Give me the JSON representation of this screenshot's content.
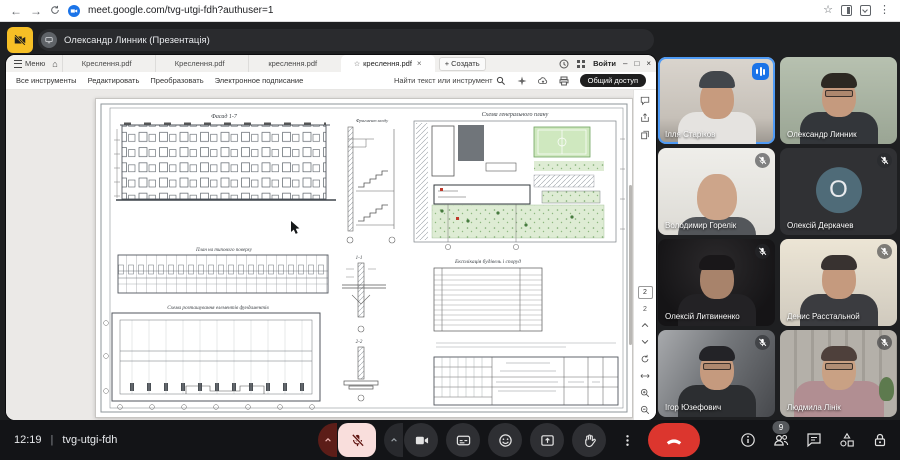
{
  "browser": {
    "url": "meet.google.com/tvg-utgi-fdh?authuser=1"
  },
  "banner": {
    "label": "Олександр Линник (Презентація)"
  },
  "acrobat": {
    "menu": "Меню",
    "tabs": [
      {
        "label": "Креслення.pdf",
        "active": false
      },
      {
        "label": "Креслення.pdf",
        "active": false
      },
      {
        "label": "креслення.pdf",
        "active": false
      },
      {
        "label": "креслення.pdf",
        "active": true
      }
    ],
    "create": "Создать",
    "signin": "Войти",
    "menus": [
      "Все инструменты",
      "Редактировать",
      "Преобразовать",
      "Электронное подписание"
    ],
    "search": "Найти текст или инструмент",
    "share_button": "Общий доступ",
    "page": "2"
  },
  "sheet": {
    "facade": "Фасад 1-7",
    "entrance": "Фрагмент входу",
    "genplan": "Схема генерального плану",
    "floorplan": "План на типового поверху",
    "sec1": "1-1",
    "sec2": "2-2",
    "table": "Експлікація будівель і споруд",
    "foundation": "Схема розташування елементів фундаментів"
  },
  "participants": [
    {
      "name": "Ілля Старіков",
      "speaking": true,
      "muted": false
    },
    {
      "name": "Олександр Линник",
      "speaking": false,
      "muted": false
    },
    {
      "name": "Володимир Горелік",
      "speaking": false,
      "muted": true
    },
    {
      "name": "Олексій Деркачев",
      "speaking": false,
      "muted": true,
      "initial": "О",
      "camera_off": true
    },
    {
      "name": "Олексій Литвиненко",
      "speaking": false,
      "muted": true
    },
    {
      "name": "Денис Расстальной",
      "speaking": false,
      "muted": true
    },
    {
      "name": "Ігор Юзефович",
      "speaking": false,
      "muted": true
    },
    {
      "name": "Людмила Лінік",
      "speaking": false,
      "muted": true
    }
  ],
  "status": {
    "time": "12:19",
    "code": "tvg-utgi-fdh"
  },
  "panel": {
    "participant_count": "9"
  },
  "controls": {
    "icons": [
      "mic-off",
      "mic-options-caret",
      "camera",
      "camera-options-caret",
      "captions",
      "reactions",
      "present-screen",
      "raise-hand",
      "more-options",
      "end-call"
    ],
    "right_icons": [
      "info",
      "people",
      "chat",
      "activities",
      "host-controls"
    ]
  },
  "colors": {
    "speaking_border": "#4e9af5",
    "audio_indicator": "#1a73e8",
    "mic_muted_bg": "#f9dedc",
    "end_call": "#dc362e",
    "presenting_chip": "#f6bf26",
    "stage_bg": "#1e1f21"
  }
}
